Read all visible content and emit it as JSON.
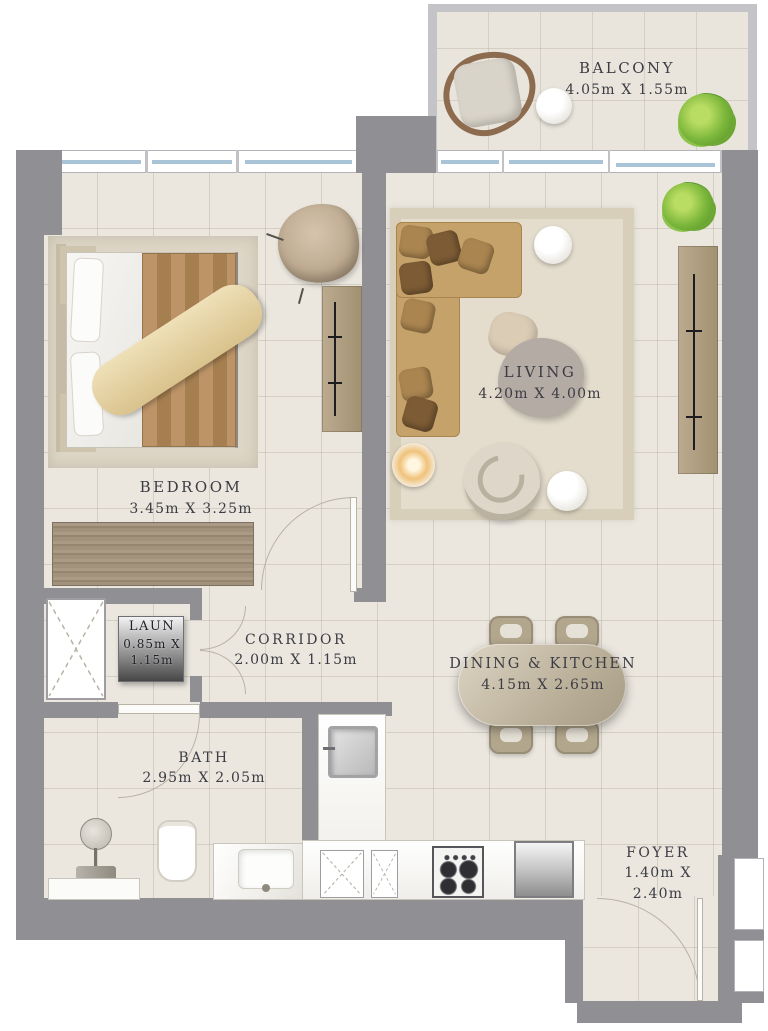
{
  "rooms": {
    "balcony": {
      "name": "BALCONY",
      "dims": "4.05m X 1.55m"
    },
    "bedroom": {
      "name": "BEDROOM",
      "dims": "3.45m X 3.25m"
    },
    "living": {
      "name": "LIVING",
      "dims": "4.20m X 4.00m"
    },
    "corridor": {
      "name": "CORRIDOR",
      "dims": "2.00m X 1.15m"
    },
    "laundry": {
      "name": "LAUN",
      "dims_line1": "0.85m X",
      "dims_line2": "1.15m"
    },
    "bath": {
      "name": "BATH",
      "dims": "2.95m X 2.05m"
    },
    "dining_kitchen": {
      "name": "DINING & KITCHEN",
      "dims": "4.15m X 2.65m"
    },
    "foyer": {
      "name": "FOYER",
      "dims_line1": "1.40m X",
      "dims_line2": "2.40m"
    }
  },
  "colors": {
    "wall": "#8f8f94",
    "wall_light": "#c4c4c8",
    "floor": "#ebe7df",
    "window_glass": "#a9c4d7",
    "cabinet_wood": "#b3a78e",
    "closet_wood": "#9d8c75",
    "sofa": "#c29f68",
    "plant_green": "#7ab63a",
    "label_text": "#3c3c44"
  }
}
